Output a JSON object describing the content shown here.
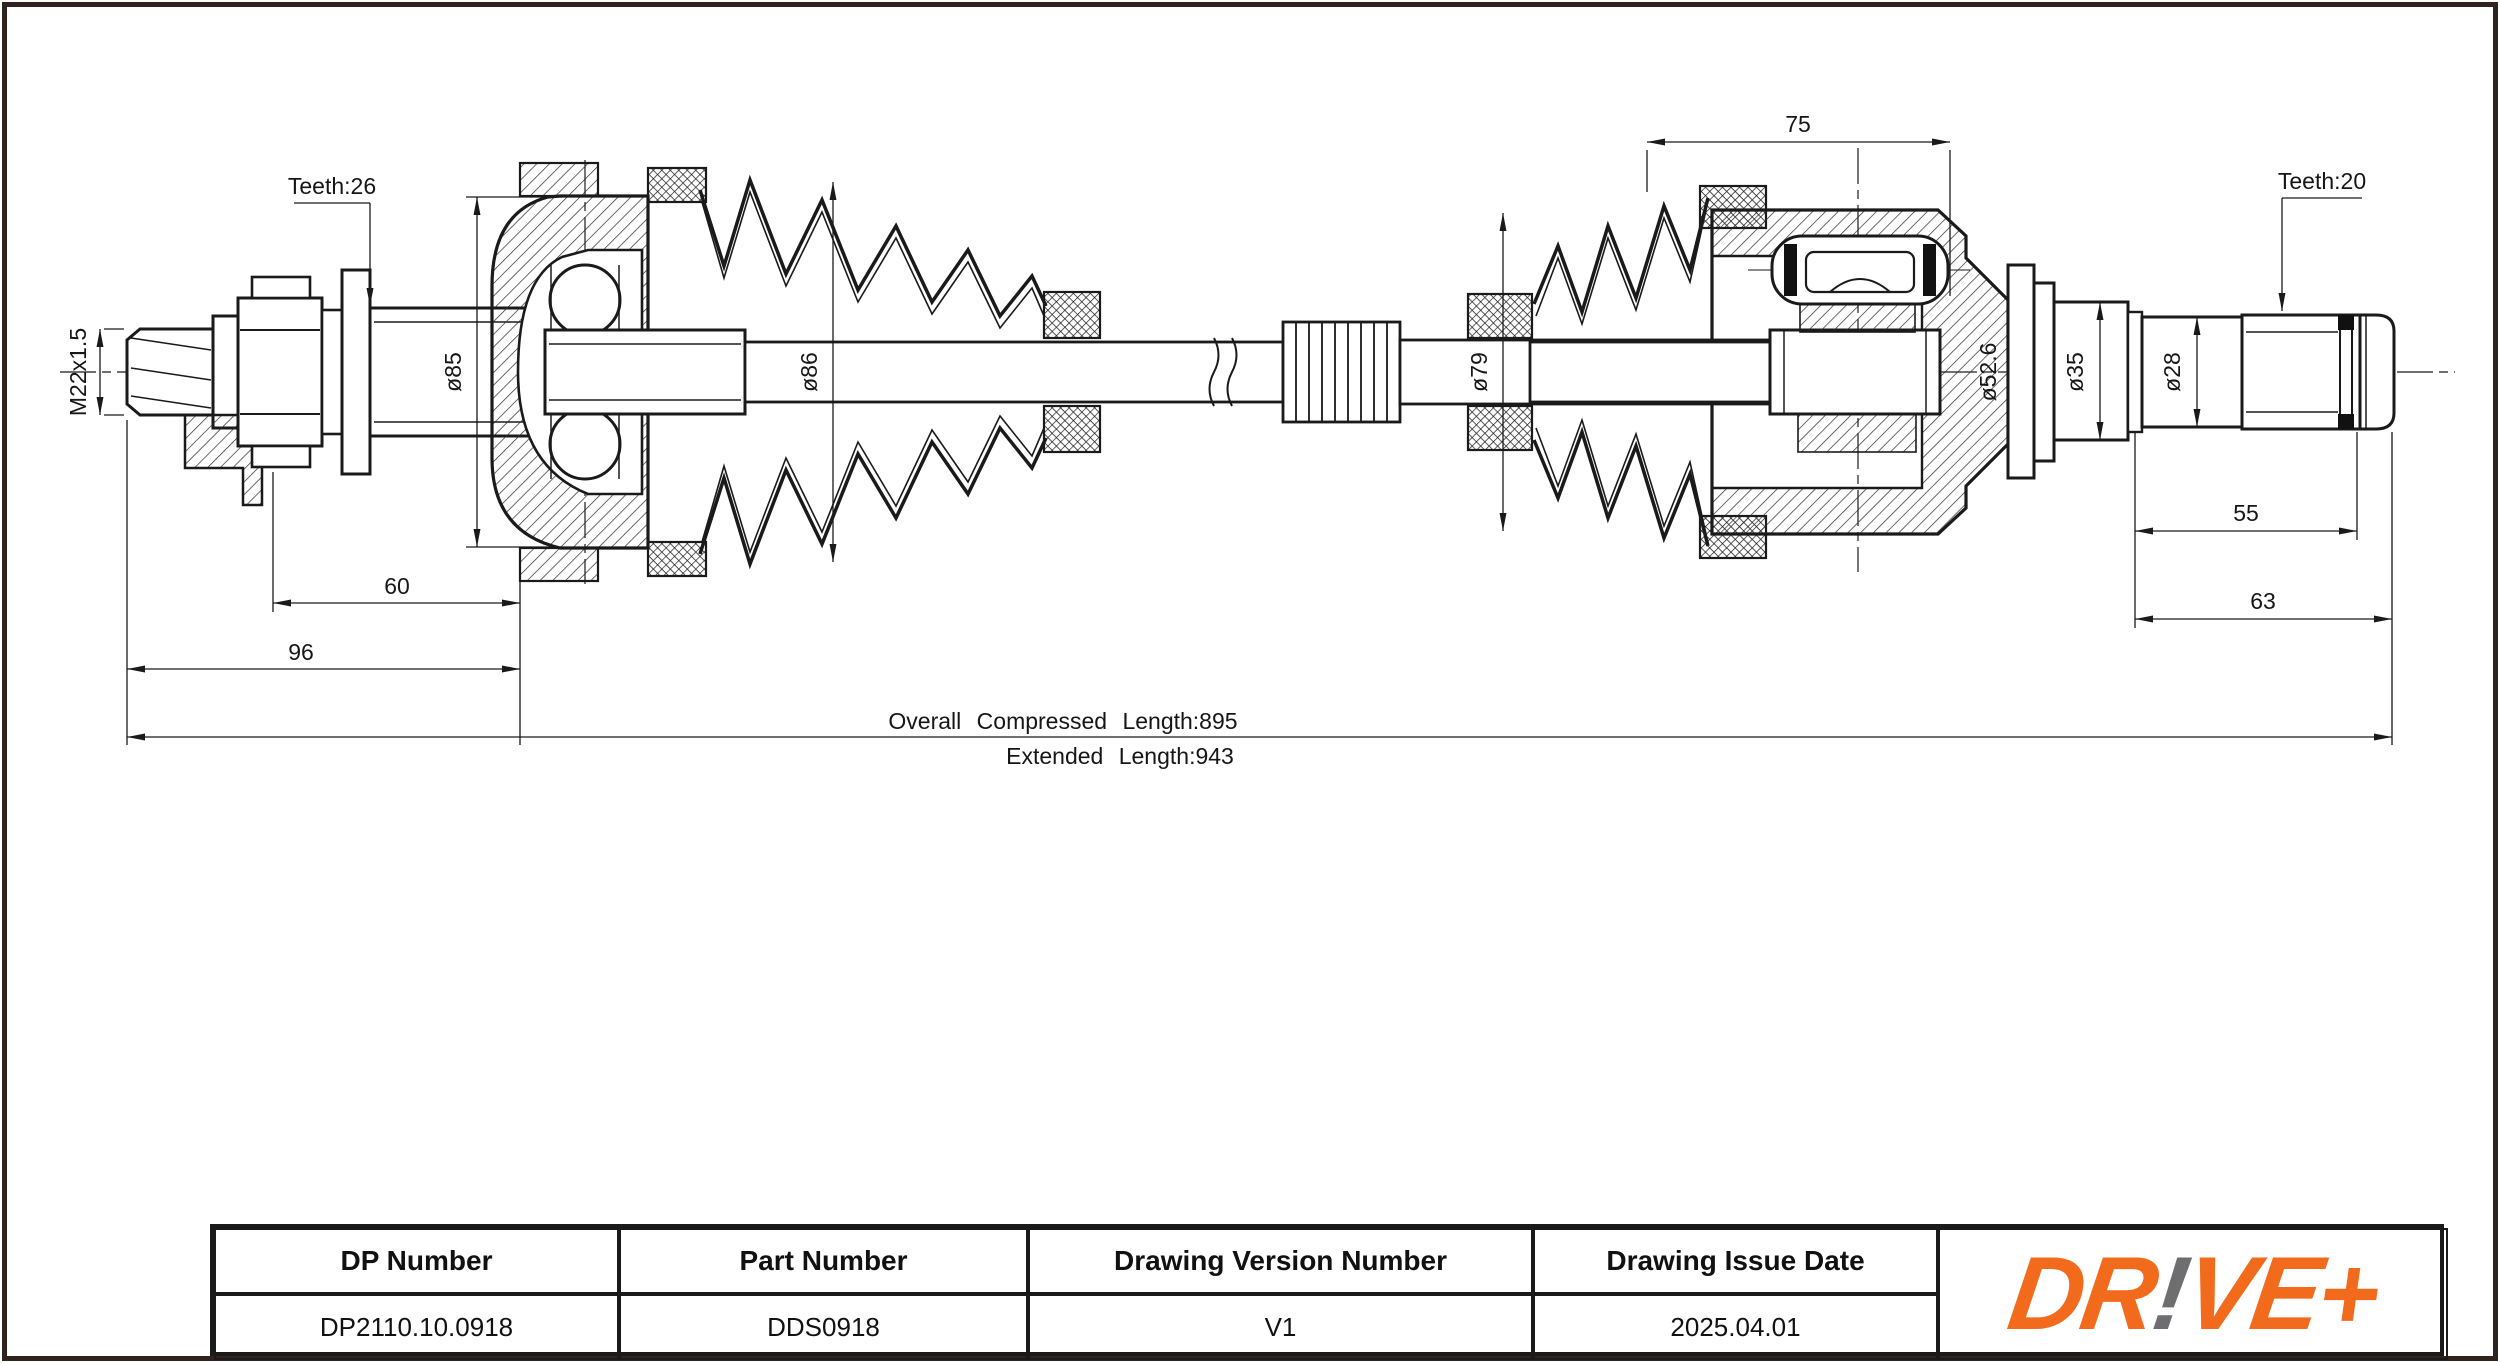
{
  "drawing": {
    "labels": {
      "teeth_left": "Teeth:26",
      "thread": "M22x1.5",
      "dia_85": "ø85",
      "dia_86": "ø86",
      "dia_79": "ø79",
      "dia_52_6": "ø52.6",
      "dia_35": "ø35",
      "dia_28": "ø28",
      "teeth_right": "Teeth:20",
      "dim_60": "60",
      "dim_96": "96",
      "dim_75": "75",
      "dim_55": "55",
      "dim_63": "63",
      "overall_compressed": "Overall  Compressed  Length:895",
      "extended": "Extended  Length:943"
    }
  },
  "title_block": {
    "fields": [
      {
        "label": "DP Number",
        "value": "DP2110.10.0918"
      },
      {
        "label": "Part Number",
        "value": "DDS0918"
      },
      {
        "label": "Drawing Version Number",
        "value": "V1"
      },
      {
        "label": "Drawing Issue Date",
        "value": "2025.04.01"
      }
    ],
    "logo": {
      "part1": "DR",
      "bang": "!",
      "part2": "VE+"
    }
  },
  "colors": {
    "line": "#1a1a1a",
    "frame": "#30231d",
    "logo_orange": "#F26B1C",
    "logo_gray": "#6E6E71"
  }
}
